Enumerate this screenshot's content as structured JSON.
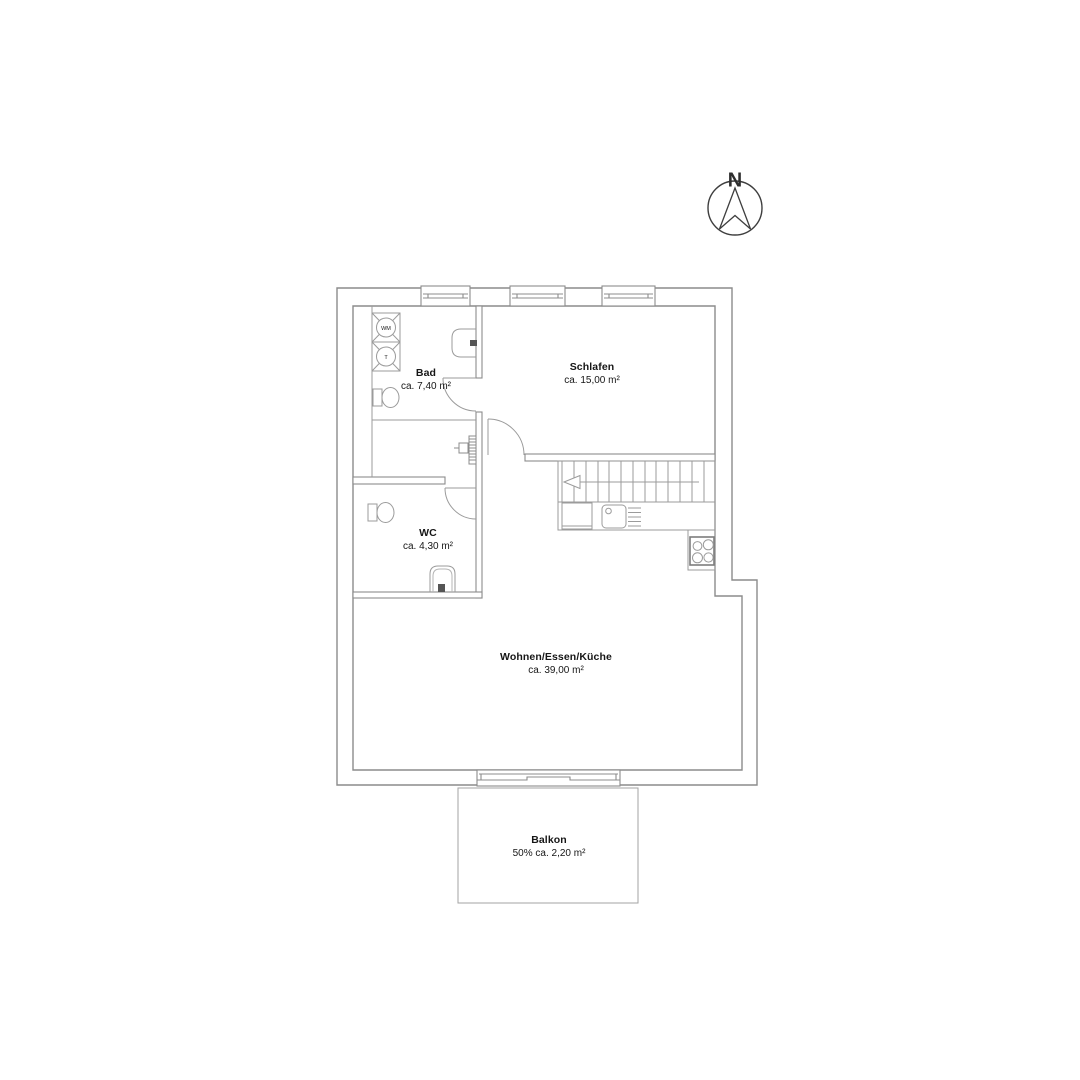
{
  "north_indicator": {
    "label": "N"
  },
  "rooms": {
    "bad": {
      "name": "Bad",
      "area": "ca. 7,40 m²"
    },
    "schlafen": {
      "name": "Schlafen",
      "area": "ca. 15,00 m²"
    },
    "wc": {
      "name": "WC",
      "area": "ca. 4,30 m²"
    },
    "wohnen": {
      "name": "Wohnen/Essen/Küche",
      "area": "ca. 39,00 m²"
    },
    "balkon": {
      "name": "Balkon",
      "area": "50% ca. 2,20 m²"
    }
  },
  "appliances": {
    "washing_machine": "WM",
    "dryer": "T"
  },
  "colors": {
    "wall_line": "#8c8c8c",
    "fixture_line": "#9b9b9b",
    "text": "#161616",
    "background": "#ffffff"
  }
}
